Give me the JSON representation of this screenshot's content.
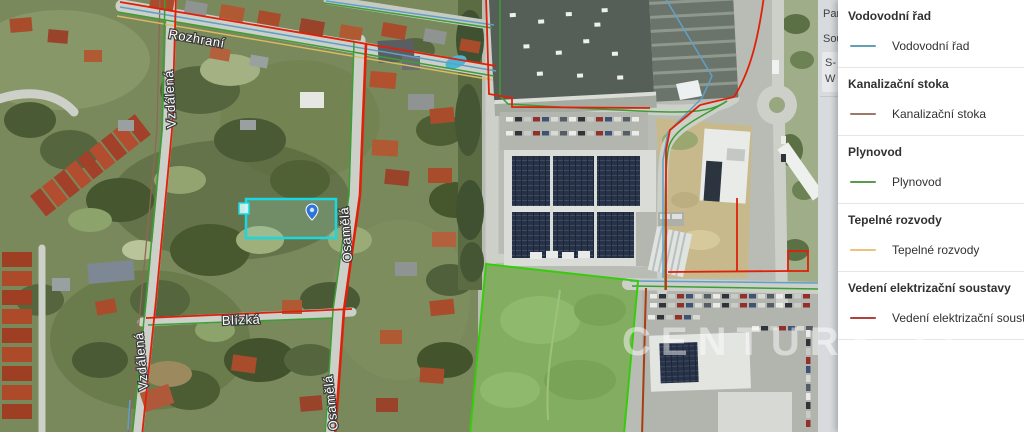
{
  "map": {
    "street_labels": {
      "rozhrani": "Rozhraní",
      "vzdalena": "Vzdálená",
      "osamela": "Osamělá",
      "blizka": "Blízká"
    },
    "watermark": "CENTURY 21",
    "colors": {
      "electric_line": "#e0200a",
      "electric_line_dark": "#a83c12",
      "gas_line": "#3c9e36",
      "water_line": "#5fa0c8",
      "heat_line": "#d9bd5f",
      "sewer_line": "#8a6a55",
      "field_outline": "#36cc0c",
      "parcel_highlight": "#1ad8e0",
      "marker": "#2f74d8"
    }
  },
  "side_strip": {
    "fragments": [
      "Parc",
      "Sou",
      "S-",
      "W"
    ]
  },
  "legend": {
    "sections": [
      {
        "title": "Vodovodní řad",
        "label": "Vodovodní řad",
        "color": "#62a0b8"
      },
      {
        "title": "Kanalizační stoka",
        "label": "Kanalizační stoka",
        "color": "#9b7a68"
      },
      {
        "title": "Plynovod",
        "label": "Plynovod",
        "color": "#5a9b4e"
      },
      {
        "title": "Tepelné rozvody",
        "label": "Tepelné rozvody",
        "color": "#eec27a"
      },
      {
        "title": "Vedení elektrizační soustavy",
        "label": "Vedení elektrizační soustavy",
        "color": "#b0413d"
      }
    ]
  }
}
